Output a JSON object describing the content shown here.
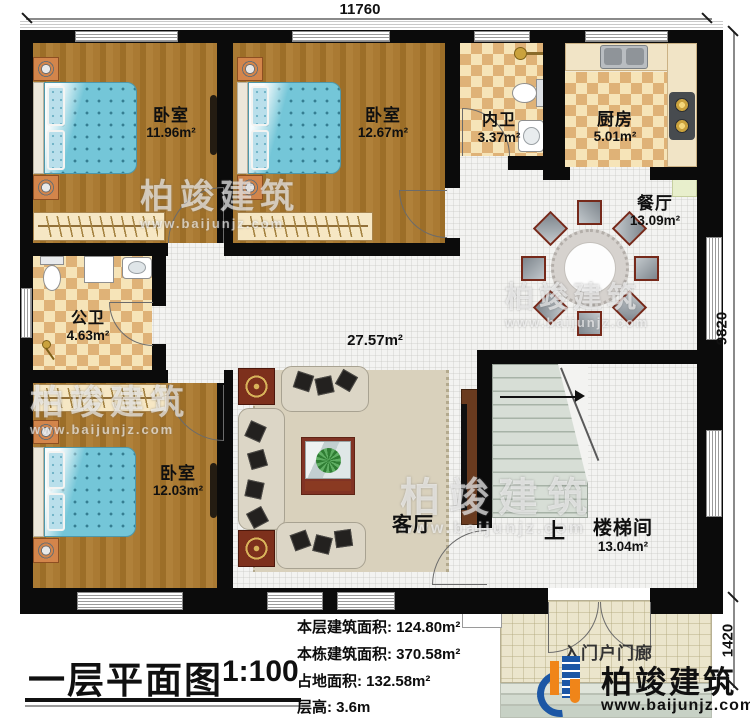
{
  "title_block": {
    "title": "一层平面图",
    "scale": "1:100"
  },
  "dimensions": {
    "top": "11760",
    "right_main": "9820",
    "right_porch": "1420"
  },
  "rooms": [
    {
      "name": "卧室",
      "area": "11.96m²"
    },
    {
      "name": "卧室",
      "area": "12.67m²"
    },
    {
      "name": "内卫",
      "area": "3.37m²"
    },
    {
      "name": "厨房",
      "area": "5.01m²"
    },
    {
      "name": "餐厅",
      "area": "13.09m²"
    },
    {
      "name": "公卫",
      "area": "4.63m²"
    },
    {
      "name": "客厅",
      "area": "27.57m²"
    },
    {
      "name": "卧室",
      "area": "12.03m²"
    },
    {
      "name": "楼梯间",
      "area": "13.04m²"
    },
    {
      "name": "入门户门廊",
      "area": ""
    }
  ],
  "stair_up_label": "上",
  "info_lines": [
    "本层建筑面积: 124.80m²",
    "本栋建筑面积: 370.58m²",
    "占地面积: 132.58m²",
    "层高: 3.6m"
  ],
  "watermark": {
    "brand": "柏竣建筑",
    "url": "www.baijunjz.com"
  },
  "logo": {
    "brand": "柏竣建筑",
    "url": "www.baijunjz.com"
  },
  "colors": {
    "wall": "#0b0b0b",
    "wood_floor": "#a3742e",
    "tile_light": "#f6e4b8",
    "tile_dark": "#dfb277",
    "bed_blue": "#74c6d8",
    "living_floor": "#f3f3f1",
    "porch_floor": "#ebe5cc",
    "logo_blue": "#1c57a5",
    "logo_orange": "#f08519"
  }
}
